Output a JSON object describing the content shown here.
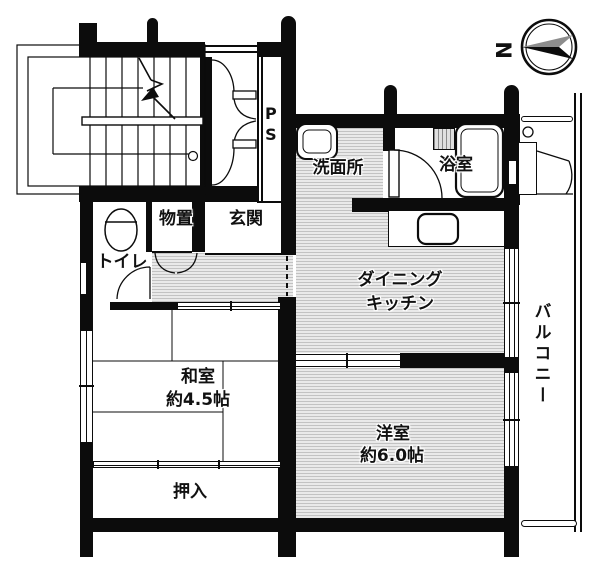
{
  "floorplan": {
    "rooms": {
      "toilet": {
        "label": "トイレ"
      },
      "storage": {
        "label": "物置"
      },
      "entrance": {
        "label": "玄関"
      },
      "pipe_space": {
        "label": "PS"
      },
      "washroom": {
        "label": "洗面所"
      },
      "bathroom": {
        "label": "浴室"
      },
      "dining_kitchen": {
        "label_line1": "ダイニング",
        "label_line2": "キッチン"
      },
      "japanese_room": {
        "label": "和室",
        "size": "約4.5帖"
      },
      "western_room": {
        "label": "洋室",
        "size": "約6.0帖"
      },
      "closet": {
        "label": "押入"
      },
      "balcony": {
        "label": "バルコニー"
      }
    },
    "compass": {
      "north_label": "N"
    },
    "colors": {
      "wall": "#0c0c0c",
      "floor_hatch_dark": "#c2c2c2",
      "floor_hatch_light": "#e9e9e9",
      "background": "#ffffff"
    }
  }
}
